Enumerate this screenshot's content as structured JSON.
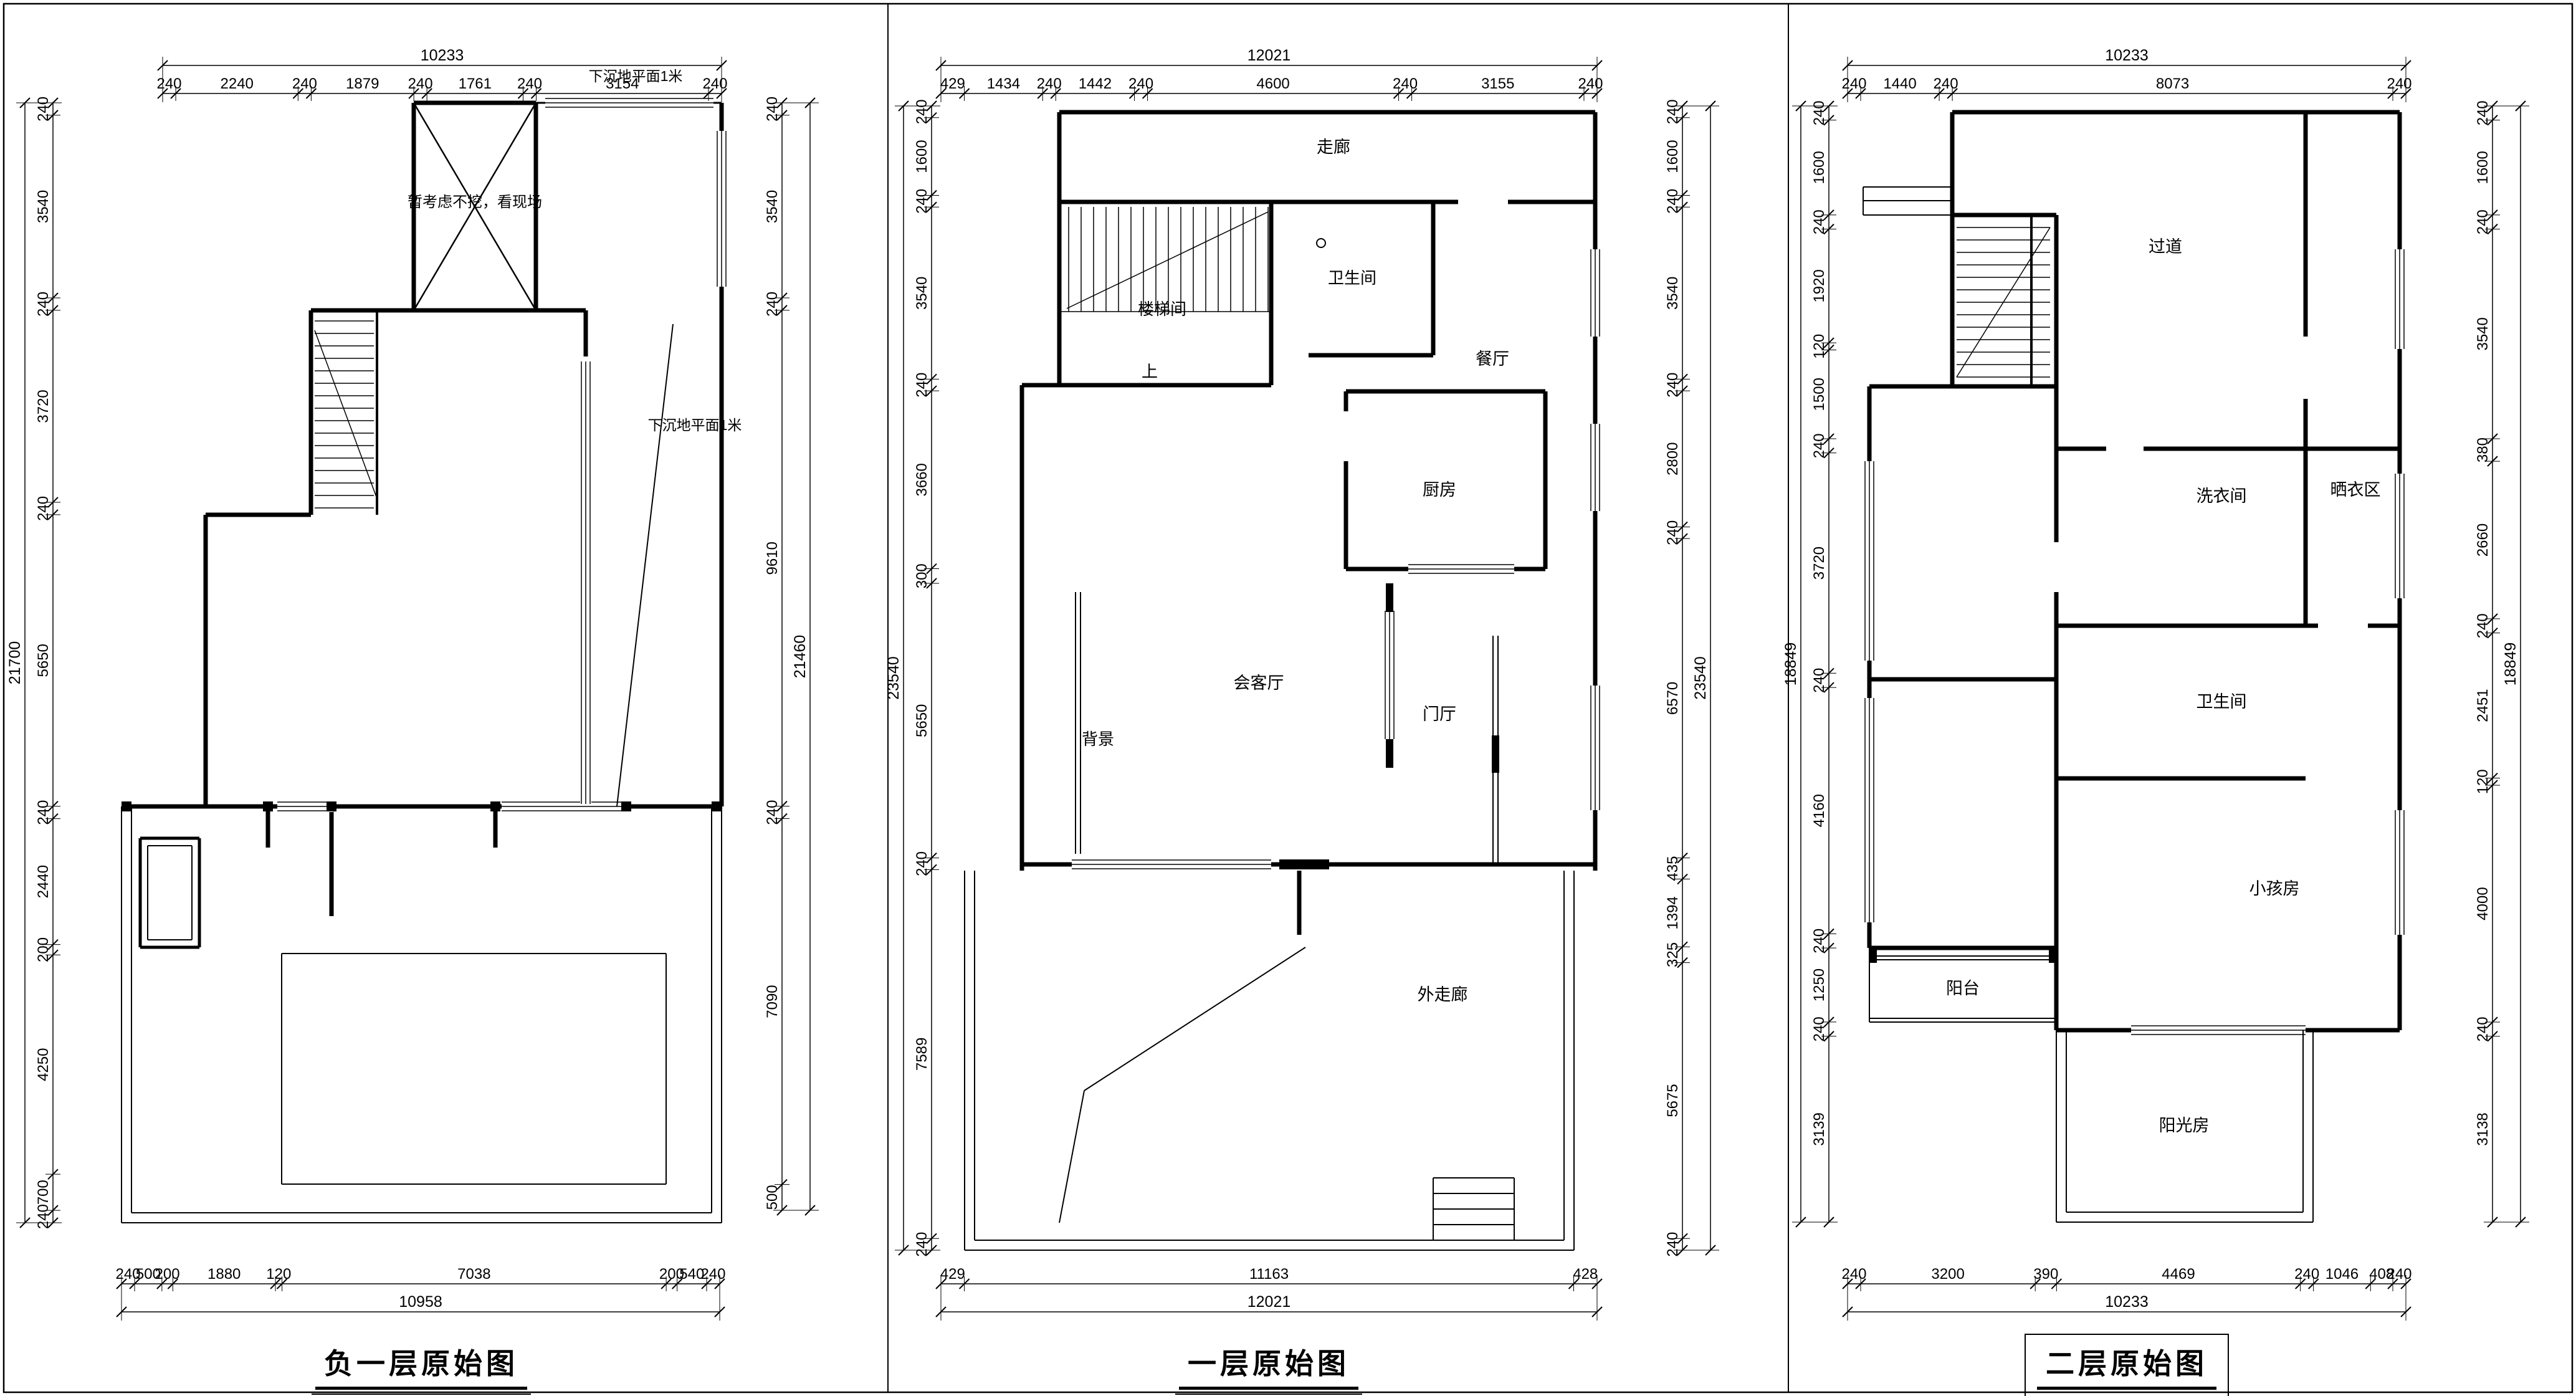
{
  "sheet": {
    "plans": [
      {
        "id": "basement",
        "title": "负一层原始图",
        "annotations": [
          "暂考虑不挖，看现场",
          "下沉地平面1米",
          "下沉地平面1米"
        ],
        "rooms": [],
        "dims": {
          "top": {
            "total": "10233",
            "segments": [
              "240",
              "2240",
              "240",
              "1879",
              "240",
              "1761",
              "240",
              "3154",
              "240"
            ]
          },
          "bottom": {
            "total": "10958",
            "segments": [
              "240",
              "500",
              "200",
              "1880",
              "120",
              "7038",
              "200",
              "540",
              "240"
            ]
          },
          "left": {
            "total": "21700",
            "segments": [
              "240",
              "3540",
              "240",
              "3720",
              "240",
              "5650",
              "240",
              "2440",
              "200",
              "4250",
              "700",
              "240"
            ]
          },
          "right": {
            "total": "21460",
            "segments": [
              "240",
              "3540",
              "240",
              "9610",
              "240",
              "7090",
              "500"
            ]
          }
        }
      },
      {
        "id": "first-floor",
        "title": "一层原始图",
        "annotations": [],
        "rooms": [
          "走廊",
          "卫生间",
          "楼梯间",
          "上",
          "餐厅",
          "厨房",
          "会客厅",
          "背景",
          "门厅",
          "外走廊"
        ],
        "dims": {
          "top": {
            "total": "12021",
            "segments": [
              "429",
              "1434",
              "240",
              "1442",
              "240",
              "4600",
              "240",
              "3155",
              "240"
            ]
          },
          "bottom": {
            "total": "12021",
            "segments": [
              "429",
              "11163",
              "428"
            ]
          },
          "left": {
            "total": "23540",
            "segments": [
              "240",
              "1600",
              "240",
              "3540",
              "240",
              "3660",
              "300",
              "5650",
              "240",
              "7589",
              "240"
            ]
          },
          "right": {
            "total": "23540",
            "segments": [
              "240",
              "1600",
              "240",
              "3540",
              "240",
              "2800",
              "240",
              "6570",
              "435",
              "1394",
              "325",
              "5675",
              "240"
            ]
          }
        }
      },
      {
        "id": "second-floor",
        "title": "二层原始图",
        "annotations": [],
        "rooms": [
          "过道",
          "洗衣间",
          "晒衣区",
          "卫生间",
          "小孩房",
          "阳台",
          "阳光房"
        ],
        "dims": {
          "top": {
            "total": "10233",
            "segments": [
              "240",
              "1440",
              "240",
              "8073",
              "240"
            ]
          },
          "bottom": {
            "total": "10233",
            "segments": [
              "240",
              "3200",
              "390",
              "4469",
              "240",
              "1046",
              "408",
              "240"
            ]
          },
          "left": {
            "total": "18849",
            "segments": [
              "240",
              "1600",
              "240",
              "1920",
              "120",
              "1500",
              "240",
              "3720",
              "240",
              "4160",
              "240",
              "1250",
              "240",
              "3139"
            ]
          },
          "right": {
            "total": "18849",
            "segments": [
              "240",
              "1600",
              "240",
              "3540",
              "380",
              "2660",
              "240",
              "2451",
              "120",
              "4000",
              "240",
              "3138"
            ]
          }
        }
      }
    ]
  }
}
